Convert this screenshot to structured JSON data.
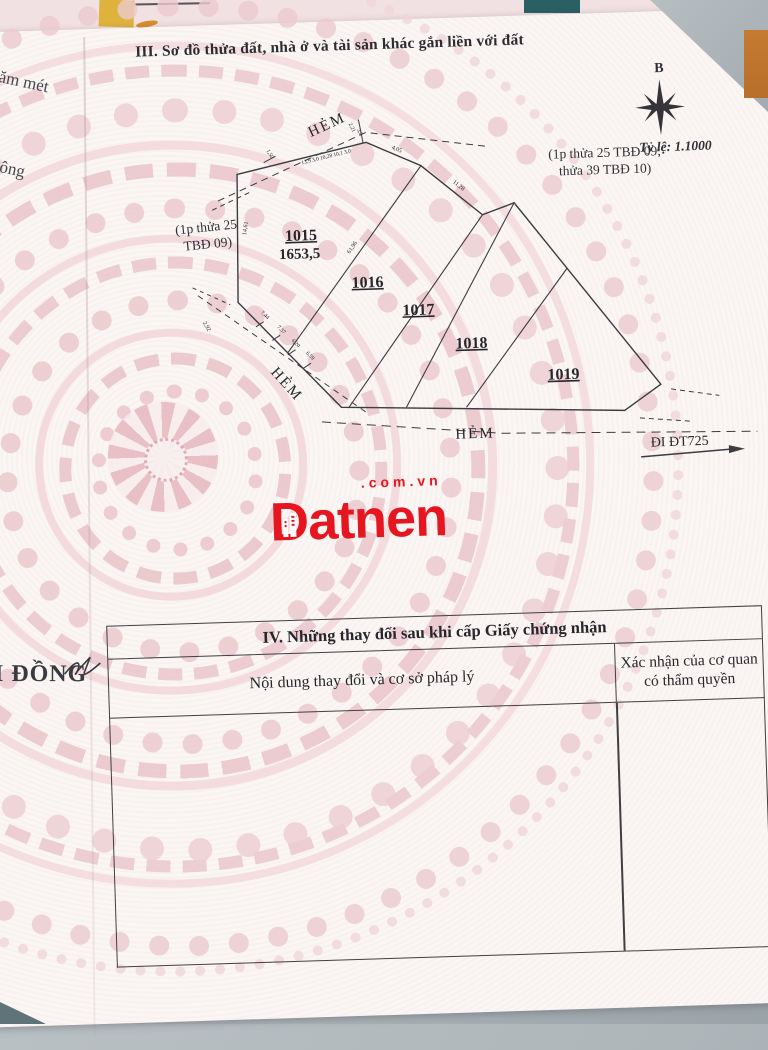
{
  "document": {
    "section3_title": "III. Sơ đồ thửa đất, nhà ở và tài sản khác gắn liền với đất",
    "side_texts": {
      "top": "năm mét",
      "middle": "không",
      "bottom": "M ĐỒNG"
    },
    "compass": {
      "north": "B",
      "scale": "Tỷ lệ: 1.1000"
    },
    "notes": {
      "right_line1": "(1p thửa 25 TBĐ 09;",
      "right_line2": "thửa 39 TBĐ 10)",
      "left_line1": "(1p thửa 25",
      "left_line2": "TBĐ 09)"
    }
  },
  "diagram": {
    "alley_top": "HẺM",
    "alley_left": "HẺM",
    "alley_bottom": "HẺM",
    "road": "ĐI ĐT725",
    "plots": [
      {
        "id": "1015",
        "area": "1653,5"
      },
      {
        "id": "1016",
        "area": ""
      },
      {
        "id": "1017",
        "area": ""
      },
      {
        "id": "1018",
        "area": ""
      },
      {
        "id": "1019",
        "area": ""
      }
    ],
    "dims": {
      "top_edge": "13,9 3,0 10,28 10,1 3,0",
      "tick_top_a": "2,21",
      "tick_top_b": "3,0",
      "tick_left": "1,50",
      "slope_a": "4,05",
      "slope_b": "11,28",
      "left_edge": "14,61",
      "divider": "61,96",
      "alley_width": "2,92",
      "bottom_edge": [
        "7,44",
        "7,37",
        "6,20",
        "6,59"
      ]
    }
  },
  "watermark": {
    "brand": "Datnen",
    "suffix": ".com.vn",
    "color": "#e5161f"
  },
  "section4": {
    "title": "IV. Những thay đổi sau khi cấp Giấy chứng nhận",
    "col_left": "Nội dung thay đổi và cơ sở pháp lý",
    "col_right_line1": "Xác nhận của cơ quan",
    "col_right_line2": "có thẩm quyền"
  },
  "colors": {
    "pattern_pink": "#e9c3c9",
    "line_dark": "#3c3c42",
    "accent_red": "#e5161f"
  }
}
